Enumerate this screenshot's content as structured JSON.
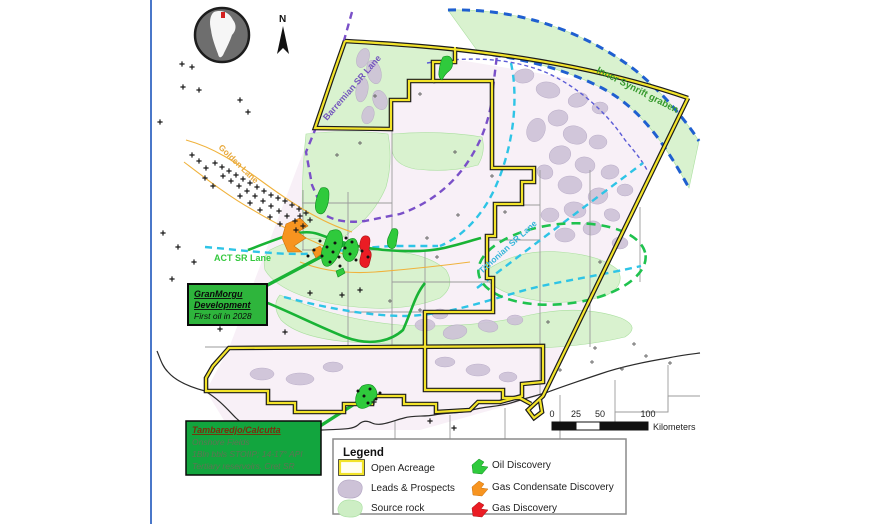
{
  "map": {
    "labels": {
      "north": "N",
      "golden_lane": "Golden Lane",
      "barremian": "Barremian SR Lane",
      "inner_synrift": "Inner Synrift graben",
      "tithonian": "Tithonian SR Lane",
      "act": "ACT SR Lane"
    },
    "callouts": {
      "granmorgu": {
        "line1": "GranMorgu",
        "line2": "Development",
        "line3": "First oil in 2028"
      },
      "tambaredjo": {
        "title": "Tambaredjo/Calcutta",
        "line1": "Onshore Fields",
        "line2": "1Bln bbls STOIIP; 14-17° API",
        "line3": "Tertiary reservoirs. Cret SR"
      }
    },
    "scale": {
      "t0": "0",
      "t25": "25",
      "t50": "50",
      "t100": "100",
      "unit": "Kilometers"
    }
  },
  "legend": {
    "title": "Legend",
    "left": [
      {
        "label": "Open Acreage"
      },
      {
        "label": "Leads & Prospects"
      },
      {
        "label": "Source rock"
      }
    ],
    "right": [
      {
        "label": "Oil Discovery"
      },
      {
        "label": "Gas Condensate Discovery"
      },
      {
        "label": "Gas Discovery"
      }
    ]
  },
  "colors": {
    "open_acreage_yellow": "#f2e32a",
    "leads_lilac": "#cdc2d7",
    "source_rock_green": "#d9f2cf",
    "oil_green": "#2fca3c",
    "gas_condensate_orange": "#f79420",
    "gas_red": "#ea1c24",
    "synrift_blue": "#1f5fd0",
    "sr_lane_purple": "#7a50c8",
    "sr_lane_cyan": "#2ec4e6",
    "callout_green": "#2eb53c"
  }
}
